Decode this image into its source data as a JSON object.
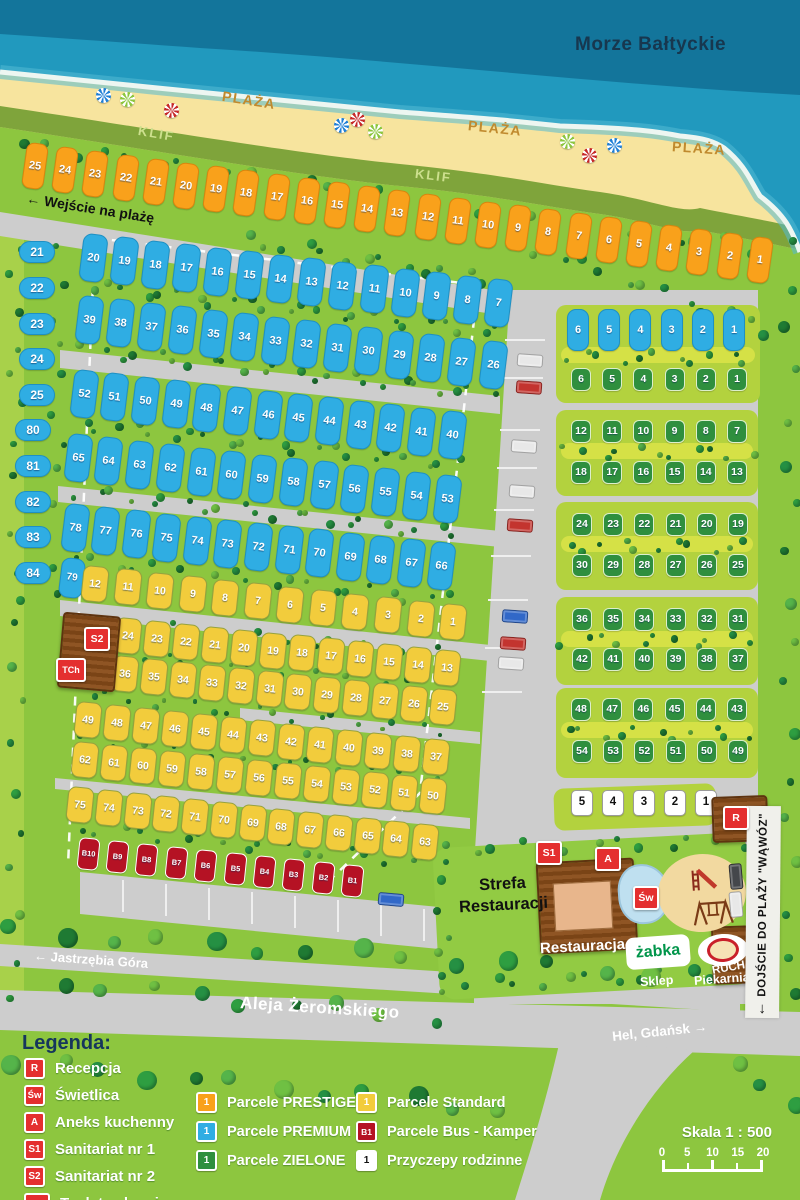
{
  "map": {
    "sea_label": "Morze Bałtyckie",
    "beach_labels": [
      "PLAŻA",
      "PLAŻA",
      "PLAŻA"
    ],
    "cliff_labels": [
      "KLIF",
      "KLIF"
    ],
    "beach_entrance": "Wejście na plażę",
    "beach_access": "DOJŚCIE DO PLAŻY \"WĄWÓZ\"",
    "road_name": "Aleja Żeromskiego",
    "direction_west": "Jastrzębia Góra",
    "direction_east": "Hel, Gdańsk",
    "restaurant_zone": "Strefa\nRestauracji",
    "restaurant": "Restauracja",
    "shop_logo": "żabka",
    "shop": "Sklep",
    "bakery": "Piekarnia",
    "kiosk": "RUCH"
  },
  "markers": {
    "reception": "R",
    "common_room": "Św",
    "kitchen": "A",
    "sanitary1": "S1",
    "sanitary2": "S2",
    "chem_toilet": "TCh"
  },
  "parcels": {
    "prestige": [
      "25",
      "24",
      "23",
      "22",
      "21",
      "20",
      "19",
      "18",
      "17",
      "16",
      "15",
      "14",
      "13",
      "12",
      "11",
      "10",
      "9",
      "8",
      "7",
      "6",
      "5",
      "4",
      "3",
      "2",
      "1"
    ],
    "premium_side1": [
      "21",
      "22",
      "23",
      "24",
      "25"
    ],
    "premium_side2": [
      "80",
      "81",
      "82",
      "83",
      "84"
    ],
    "premium_row1": [
      "20",
      "19",
      "18",
      "17",
      "16",
      "15",
      "14",
      "13",
      "12",
      "11",
      "10",
      "9",
      "8",
      "7"
    ],
    "premium_row2": [
      "39",
      "38",
      "37",
      "36",
      "35",
      "34",
      "33",
      "32",
      "31",
      "30",
      "29",
      "28",
      "27",
      "26"
    ],
    "premium_row3": [
      "52",
      "51",
      "50",
      "49",
      "48",
      "47",
      "46",
      "45",
      "44",
      "43",
      "42",
      "41",
      "40"
    ],
    "premium_row4": [
      "65",
      "64",
      "63",
      "62",
      "61",
      "60",
      "59",
      "58",
      "57",
      "56",
      "55",
      "54",
      "53"
    ],
    "premium_row5": [
      "78",
      "77",
      "76",
      "75",
      "74",
      "73",
      "72",
      "71",
      "70",
      "69",
      "68",
      "67",
      "66"
    ],
    "premium_79": [
      "79"
    ],
    "standard_row1": [
      "12",
      "11",
      "10",
      "9",
      "8",
      "7",
      "6",
      "5",
      "4",
      "3",
      "2",
      "1"
    ],
    "standard_row2": [
      "24",
      "23",
      "22",
      "21",
      "20",
      "19",
      "18",
      "17",
      "16",
      "15",
      "14",
      "13"
    ],
    "standard_row3": [
      "36",
      "35",
      "34",
      "33",
      "32",
      "31",
      "30",
      "29",
      "28",
      "27",
      "26",
      "25"
    ],
    "standard_row4": [
      "49",
      "48",
      "47",
      "46",
      "45",
      "44",
      "43",
      "42",
      "41",
      "40",
      "39",
      "38",
      "37"
    ],
    "standard_row5": [
      "62",
      "61",
      "60",
      "59",
      "58",
      "57",
      "56",
      "55",
      "54",
      "53",
      "52",
      "51",
      "50"
    ],
    "standard_row6": [
      "75",
      "74",
      "73",
      "72",
      "71",
      "70",
      "69",
      "68",
      "67",
      "66",
      "65",
      "64",
      "63"
    ],
    "bus": [
      "B10",
      "B9",
      "B8",
      "B7",
      "B6",
      "B5",
      "B4",
      "B3",
      "B2",
      "B1"
    ],
    "right_premium": [
      "6",
      "5",
      "4",
      "3",
      "2",
      "1"
    ],
    "zielone_row1": [
      "6",
      "5",
      "4",
      "3",
      "2",
      "1"
    ],
    "zielone_row2": [
      "12",
      "11",
      "10",
      "9",
      "8",
      "7"
    ],
    "zielone_row3": [
      "18",
      "17",
      "16",
      "15",
      "14",
      "13"
    ],
    "zielone_row4": [
      "24",
      "23",
      "22",
      "21",
      "20",
      "19"
    ],
    "zielone_row5": [
      "30",
      "29",
      "28",
      "27",
      "26",
      "25"
    ],
    "zielone_row6": [
      "36",
      "35",
      "34",
      "33",
      "32",
      "31"
    ],
    "zielone_row7": [
      "42",
      "41",
      "40",
      "39",
      "38",
      "37"
    ],
    "zielone_row8": [
      "48",
      "47",
      "46",
      "45",
      "44",
      "43"
    ],
    "zielone_row9": [
      "54",
      "53",
      "52",
      "51",
      "50",
      "49"
    ],
    "trailers": [
      "5",
      "4",
      "3",
      "2",
      "1"
    ]
  },
  "legend": {
    "title": "Legenda:",
    "facilities": [
      {
        "icon": "R",
        "label": "Recepcja"
      },
      {
        "icon": "Św",
        "label": "Świetlica"
      },
      {
        "icon": "A",
        "label": "Aneks kuchenny"
      },
      {
        "icon": "S1",
        "label": "Sanitariat nr 1"
      },
      {
        "icon": "S2",
        "label": "Sanitariat nr 2"
      },
      {
        "icon": "TCh",
        "label": "Toaleta chemiczna"
      }
    ],
    "types": [
      {
        "icon": "1",
        "style": "prestige",
        "label": "Parcele PRESTIGE"
      },
      {
        "icon": "1",
        "style": "premium",
        "label": "Parcele PREMIUM"
      },
      {
        "icon": "1",
        "style": "zielone",
        "label": "Parcele ZIELONE"
      },
      {
        "icon": "1",
        "style": "standard",
        "label": "Parcele Standard"
      },
      {
        "icon": "B1",
        "style": "bus",
        "label": "Parcele Bus - Kamper"
      },
      {
        "icon": "1",
        "style": "white",
        "label": "Przyczepy rodzinne"
      }
    ]
  },
  "scale": {
    "label": "Skala 1 : 500",
    "ticks": [
      "0",
      "5",
      "10",
      "15",
      "20"
    ]
  },
  "colors": {
    "sea": "#1B8FB4",
    "sand": "#F7E49E",
    "cliff": "#7FA43B",
    "grass": "#8DC63F",
    "road": "#CDCDCD",
    "prestige": "#F9A11B",
    "premium": "#2FADE3",
    "zielone": "#2F8F3E",
    "standard": "#F2CC3C",
    "bus": "#B51224",
    "marker": "#E42F2F"
  }
}
